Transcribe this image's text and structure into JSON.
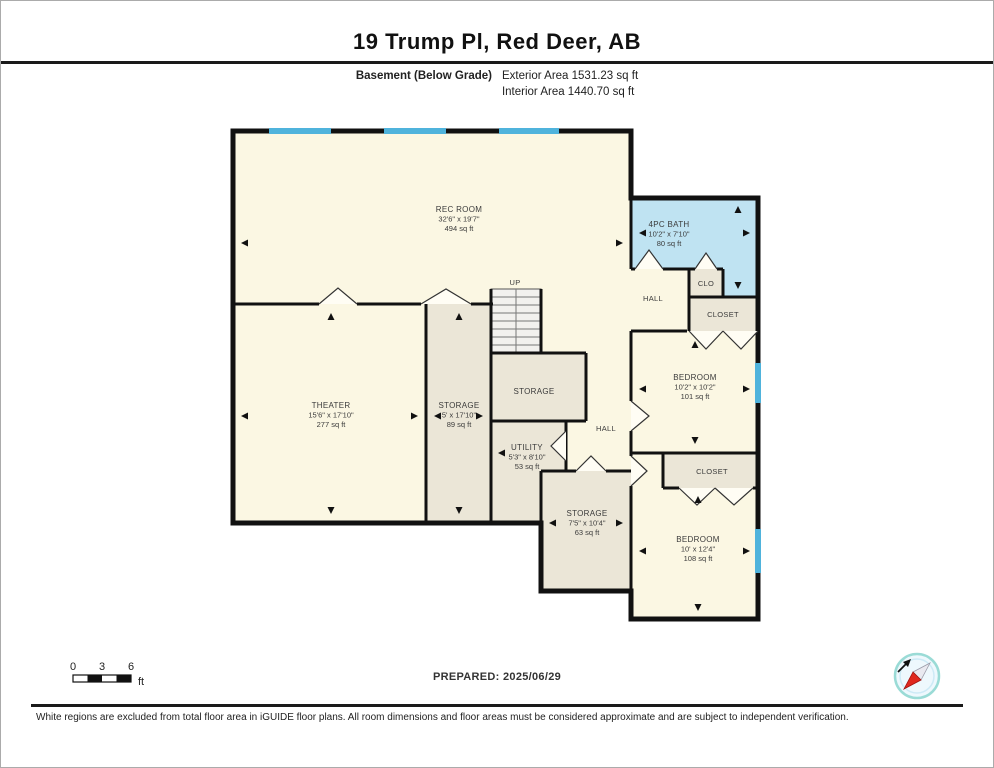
{
  "header": {
    "title": "19 Trump Pl, Red Deer, AB",
    "floor_label": "Basement (Below Grade)",
    "exterior_area": "Exterior Area 1531.23 sq ft",
    "interior_area": "Interior Area 1440.70 sq ft"
  },
  "rooms": {
    "rec_room": {
      "name": "REC ROOM",
      "dims": "32'6\" x 19'7\"",
      "area": "494 sq ft"
    },
    "theater": {
      "name": "THEATER",
      "dims": "15'6\" x 17'10\"",
      "area": "277 sq ft"
    },
    "storage_tall": {
      "name": "STORAGE",
      "dims": "5' x 17'10\"",
      "area": "89 sq ft"
    },
    "storage_mid": {
      "name": "STORAGE"
    },
    "utility": {
      "name": "UTILITY",
      "dims": "5'3\" x 8'10\"",
      "area": "53 sq ft"
    },
    "bath": {
      "name": "4PC BATH",
      "dims": "10'2\" x 7'10\"",
      "area": "80 sq ft"
    },
    "bedroom_upper": {
      "name": "BEDROOM",
      "dims": "10'2\" x 10'2\"",
      "area": "101 sq ft"
    },
    "bedroom_lower": {
      "name": "BEDROOM",
      "dims": "10' x 12'4\"",
      "area": "108 sq ft"
    },
    "storage_bottom": {
      "name": "STORAGE",
      "dims": "7'5\" x 10'4\"",
      "area": "63 sq ft"
    },
    "hall_top": {
      "name": "HALL"
    },
    "hall_mid": {
      "name": "HALL"
    },
    "clo": {
      "name": "CLO"
    },
    "closet_top": {
      "name": "CLOSET"
    },
    "closet_mid": {
      "name": "CLOSET"
    },
    "stairs": {
      "label": "UP"
    }
  },
  "scale_bar": {
    "t0": "0",
    "t3": "3",
    "t6": "6",
    "unit": "ft"
  },
  "prepared": "PREPARED: 2025/06/29",
  "disclaimer": "White regions are excluded from total floor area in iGUIDE floor plans. All room dimensions and floor areas must be considered approximate and are subject to independent verification.",
  "colors": {
    "room_cream": "#FBF7E3",
    "room_tan": "#EBE6D7",
    "room_blue": "#BFE3F2",
    "window_blue": "#4FB3DC",
    "wall": "#111111",
    "compass_red": "#E0281E"
  }
}
